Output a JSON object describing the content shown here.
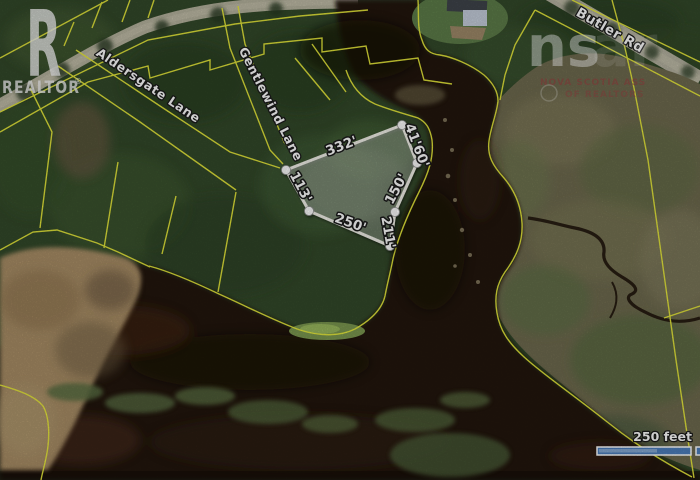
{
  "map": {
    "type": "satellite-parcel-map",
    "roads": [
      "Aldersgate Lane",
      "Gentlewind Lane",
      "Butler Rd"
    ],
    "lot": {
      "dimensions": [
        "332'",
        "41'60'",
        "150'",
        "211'",
        "250'",
        "113'"
      ]
    },
    "scale_bar": {
      "label": "250 feet"
    },
    "watermarks": {
      "realtor": {
        "r": "R",
        "word": "REALTOR",
        "reg": "®"
      },
      "nsar": {
        "big": "ns",
        "faint": "ar",
        "line1": "NOVA SCOTIA ASS",
        "line2": "OF REALTORS"
      }
    },
    "colors": {
      "forest": "#33492a",
      "water": "#24150c",
      "marsh": "#6f6b4f",
      "tan_marsh": "#a98e66",
      "parcel_line": "#e9eb3c",
      "lot_outline": "#f3f2ea",
      "scale_bar_fill": "#4d7fbe"
    }
  }
}
